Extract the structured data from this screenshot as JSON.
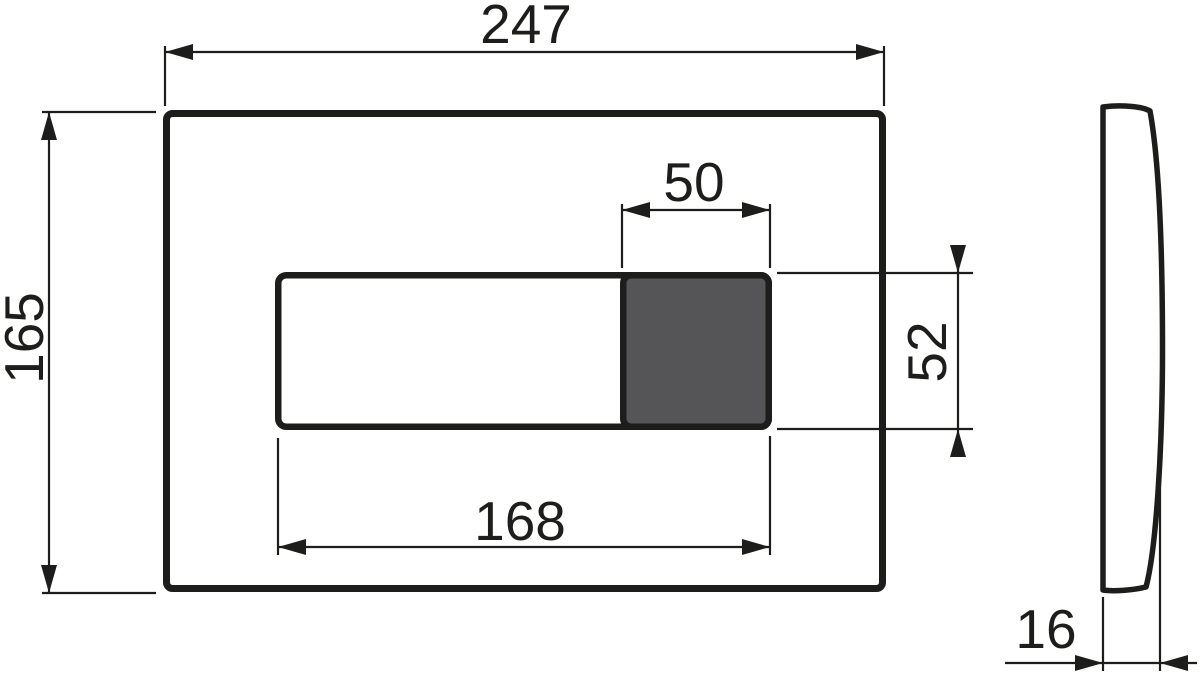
{
  "drawing": {
    "background_color": "#ffffff",
    "line_color": "#1d1d1b",
    "front_view": {
      "plate_width": "247",
      "plate_height": "165",
      "recess_width": "168",
      "recess_height": "52",
      "button_width": "50",
      "button_fill": "#555557"
    },
    "side_view": {
      "thickness": "16"
    }
  }
}
